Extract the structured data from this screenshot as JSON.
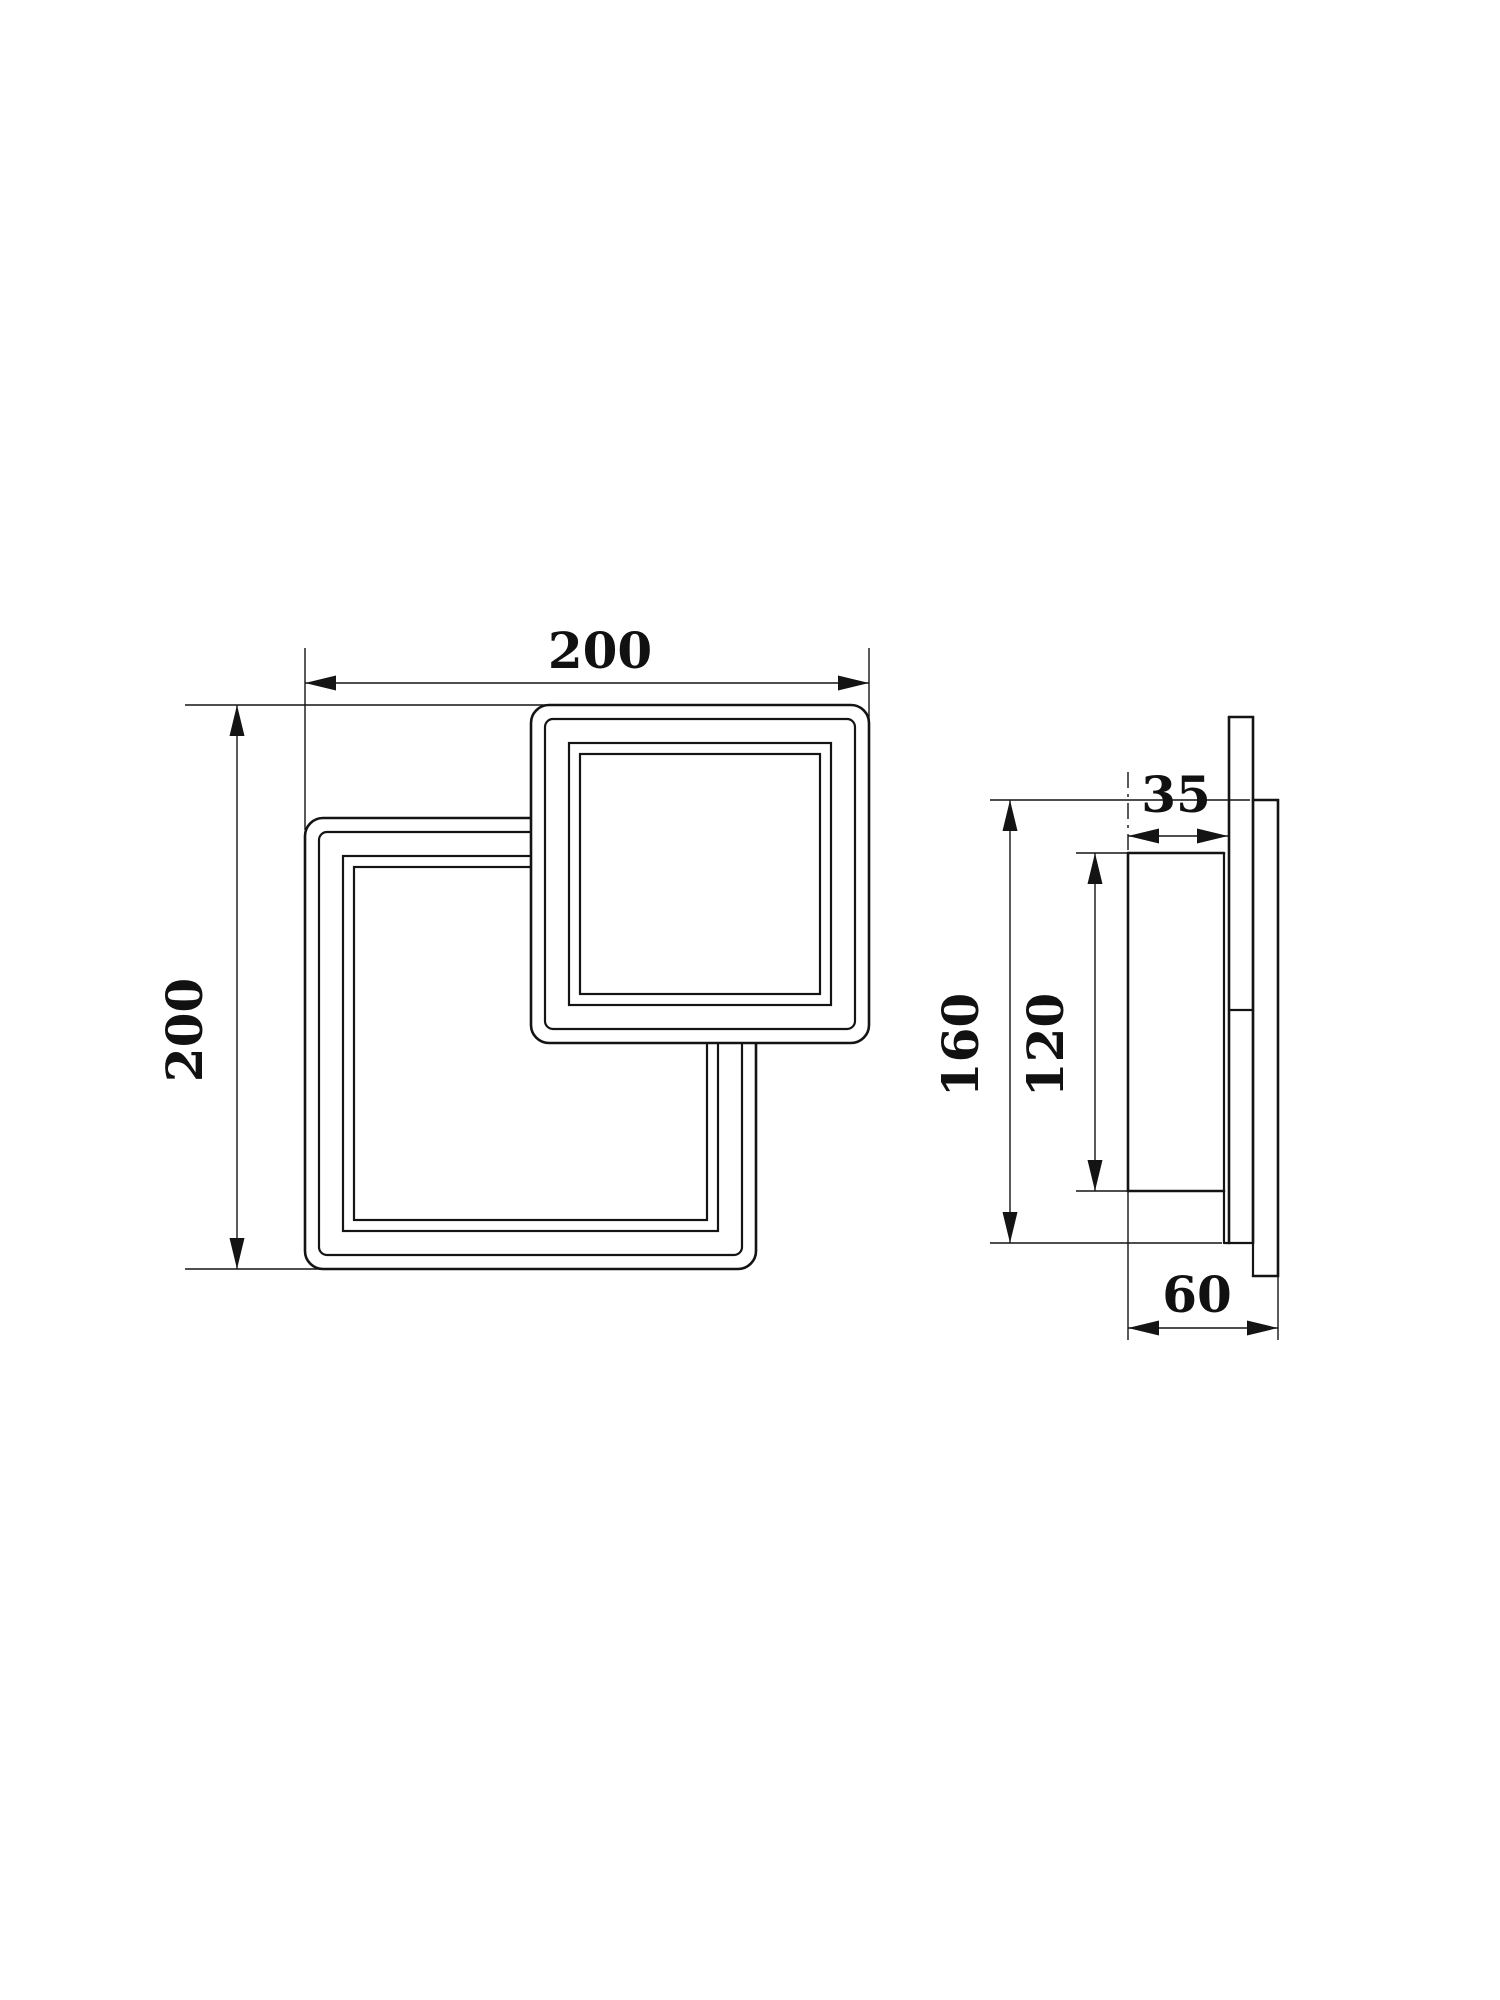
{
  "drawing": {
    "background_color": "#ffffff",
    "line_color": "#141414",
    "views": {
      "front": {
        "title": "front-view",
        "width_dim": {
          "value": "200"
        },
        "height_dim": {
          "value": "200"
        }
      },
      "side": {
        "title": "side-view",
        "body_depth_dim": {
          "value": "35"
        },
        "overall_height_dim": {
          "value": "160"
        },
        "panel_height_dim": {
          "value": "120"
        },
        "overall_depth_dim": {
          "value": "60"
        }
      }
    }
  }
}
